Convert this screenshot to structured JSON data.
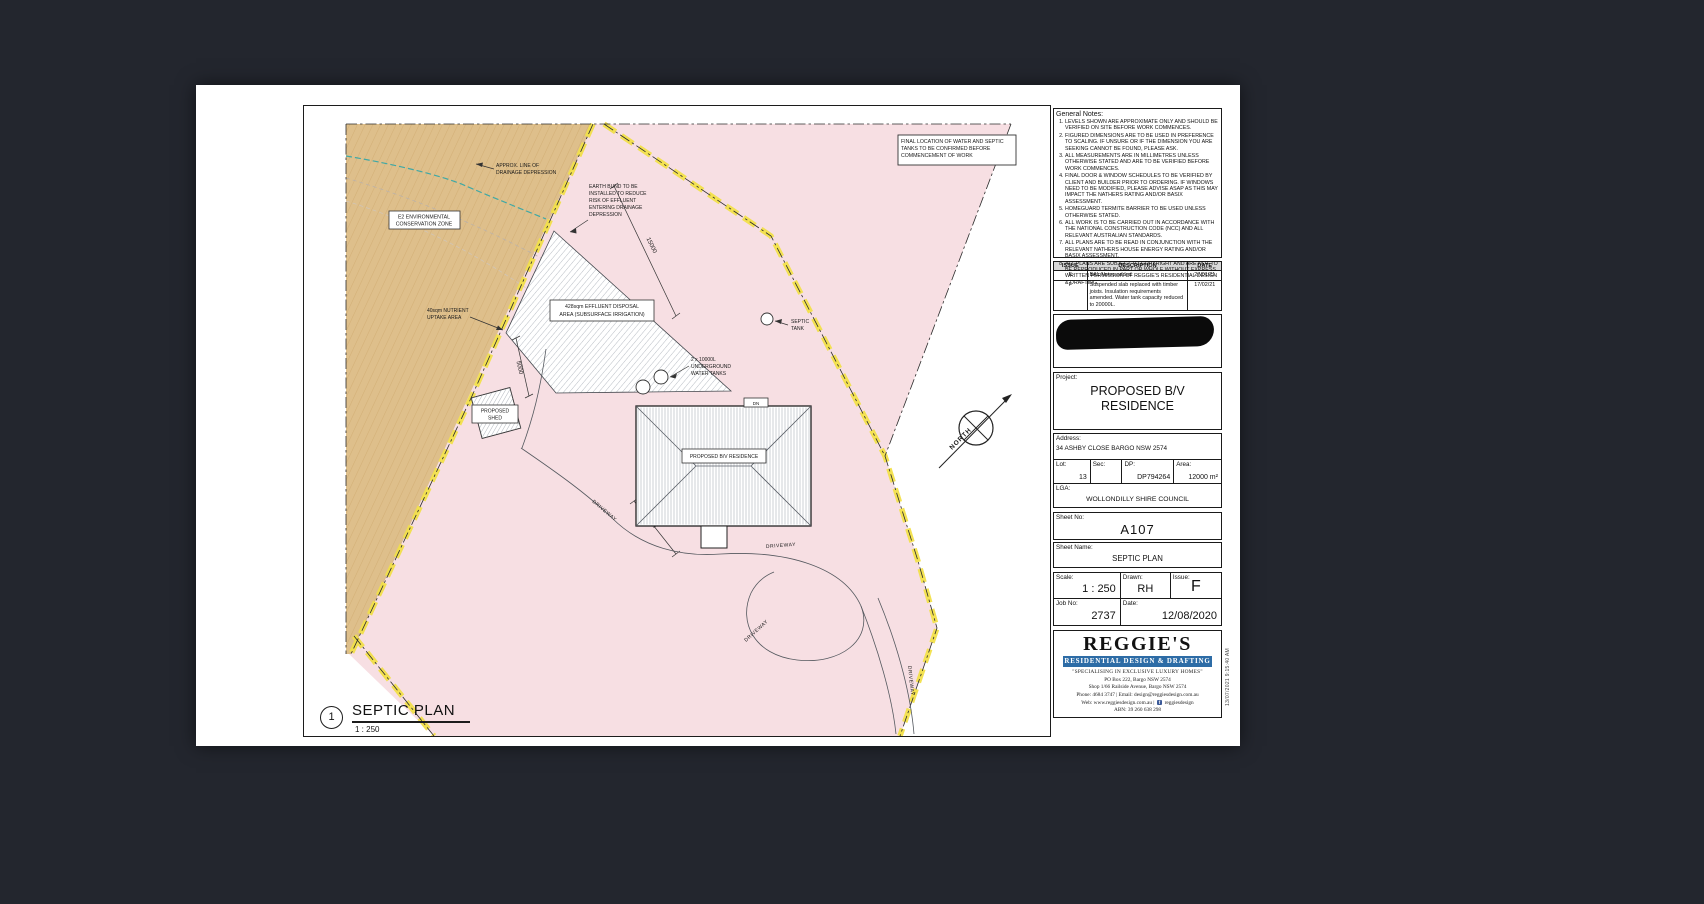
{
  "page": {
    "plot_timestamp": "13/07/2021 9:15:40 AM"
  },
  "plan": {
    "title_number": "1",
    "title": "SEPTIC PLAN",
    "scale_text": "1 : 250",
    "dimensions": [
      "15000",
      "5000",
      "5000"
    ],
    "labels": {
      "final_location": [
        "FINAL LOCATION OF WATER AND SEPTIC",
        "TANKS TO BE CONFIRMED BEFORE",
        "COMMENCEMENT OF WORK"
      ],
      "drainage": [
        "APPROX. LINE OF",
        "DRAINAGE DEPRESSION"
      ],
      "earth_bund": [
        "EARTH BUND TO BE",
        "INSTALLED TO REDUCE",
        "RISK OF EFFLUENT",
        "ENTERING DRAINAGE",
        "DEPRESSION"
      ],
      "e2_zone": [
        "E2 ENVIRONMENTAL",
        "CONSERVATION ZONE"
      ],
      "effluent": [
        "428sqm EFFLUENT DISPOSAL",
        "AREA (SUBSURFACE IRRIGATION)"
      ],
      "nutrient": [
        "40sqm NUTRIENT",
        "UPTAKE AREA"
      ],
      "water_tanks": [
        "2 x 10000L",
        "UNDERGROUND",
        "WATER TANKS"
      ],
      "septic_tank": [
        "SEPTIC",
        "TANK"
      ],
      "shed": [
        "PROPOSED",
        "SHED"
      ],
      "residence": "PROPOSED B/V RESIDENCE",
      "dn": "DN",
      "north": "NORTH",
      "driveway": "DRIVEWAY"
    }
  },
  "titleblock": {
    "general_notes": {
      "title": "General Notes:",
      "notes": [
        "LEVELS SHOWN ARE APPROXIMATE ONLY AND SHOULD BE VERIFIED ON SITE BEFORE WORK COMMENCES.",
        "FIGURED DIMENSIONS ARE TO BE USED IN PREFERENCE TO SCALING. IF UNSURE OR IF THE DIMENSION YOU ARE SEEKING CANNOT BE FOUND, PLEASE ASK.",
        "ALL MEASUREMENTS ARE IN MILLIMETRES UNLESS OTHERWISE STATED AND ARE TO BE VERIFIED BEFORE WORK COMMENCES.",
        "FINAL DOOR & WINDOW SCHEDULES TO BE VERIFIED BY CLIENT AND BUILDER PRIOR TO ORDERING. IF WINDOWS NEED TO BE MODIFIED, PLEASE ADVISE ASAP AS THIS MAY IMPACT THE NATHERS RATING AND/OR BASIX ASSESSMENT.",
        "HOMEGUARD TERMITE BARRIER TO BE USED UNLESS OTHERWISE STATED.",
        "ALL WORK IS TO BE CARRIED OUT IN ACCORDANCE WITH THE NATIONAL CONSTRUCTION CODE (NCC) AND ALL RELEVANT AUSTRALIAN STANDARDS.",
        "ALL PLANS ARE TO BE READ IN CONJUNCTION WITH THE RELEVANT NATHERS HOUSE ENERGY RATING AND/OR BASIX ASSESSMENT.",
        "ALL PLANS ARE SUBJECT TO COPYRIGHT AND ARE NOT TO BE REPRODUCED IN PART OR WHOLE WITHOUT EXPRESS WRITTEN PERMISSION OF REGGIE'S RESIDENTIAL DESIGN & DRAFTING."
      ]
    },
    "issue_table": {
      "headers": [
        "ISSUE",
        "DESCRIPTION",
        "DATE"
      ],
      "rows": [
        {
          "issue": "E",
          "description": "BAL Notes added",
          "date": "27/01/21"
        },
        {
          "issue": "F",
          "description": "Suspended slab replaced with timber joists. Insulation requirements amended. Water tank capacity reduced to 20000L.",
          "date": "17/02/21"
        }
      ]
    },
    "project": {
      "label": "Project:",
      "value": "PROPOSED B/V RESIDENCE"
    },
    "address": {
      "label": "Address:",
      "value": "34 ASHBY CLOSE BARGO NSW 2574"
    },
    "lot": {
      "label": "Lot:",
      "value": "13"
    },
    "sec": {
      "label": "Sec:",
      "value": ""
    },
    "dp": {
      "label": "DP:",
      "value": "DP794264"
    },
    "area": {
      "label": "Area:",
      "value": "12000 m²"
    },
    "lga": {
      "label": "LGA:",
      "value": "WOLLONDILLY SHIRE COUNCIL"
    },
    "sheet_no": {
      "label": "Sheet No:",
      "value": "A107"
    },
    "sheet_name": {
      "label": "Sheet Name:",
      "value": "SEPTIC PLAN"
    },
    "scale": {
      "label": "Scale:",
      "value": "1 : 250"
    },
    "drawn": {
      "label": "Drawn:",
      "value": "RH"
    },
    "issue": {
      "label": "Issue:",
      "value": "F"
    },
    "job_no": {
      "label": "Job No:",
      "value": "2737"
    },
    "date": {
      "label": "Date:",
      "value": "12/08/2020"
    },
    "brand": {
      "name": "REGGIE'S",
      "banner": "RESIDENTIAL DESIGN & DRAFTING",
      "tagline": "\"SPECIALISING IN EXCLUSIVE LUXURY HOMES\"",
      "address1": "PO Box 222, Bargo NSW 2574",
      "address2": "Shop 1/66 Railside Avenue, Bargo NSW 2574",
      "contact": "Phone: 4684 3747 | Email: design@reggiesdesign.com.au",
      "web_prefix": "Web: www.reggiesdesign.com.au |",
      "facebook": "reggiesdesign",
      "abn": "ABN: 39 260 638 298"
    }
  },
  "colors": {
    "background": "#23262e",
    "site_pink": "#f7dfe3",
    "zone_tan": "#debf8b",
    "boundary_yellow": "#f2e04a",
    "drainage_teal": "#3fa8a5",
    "brand_blue": "#2d6ca6",
    "facebook_blue": "#3b5998"
  }
}
